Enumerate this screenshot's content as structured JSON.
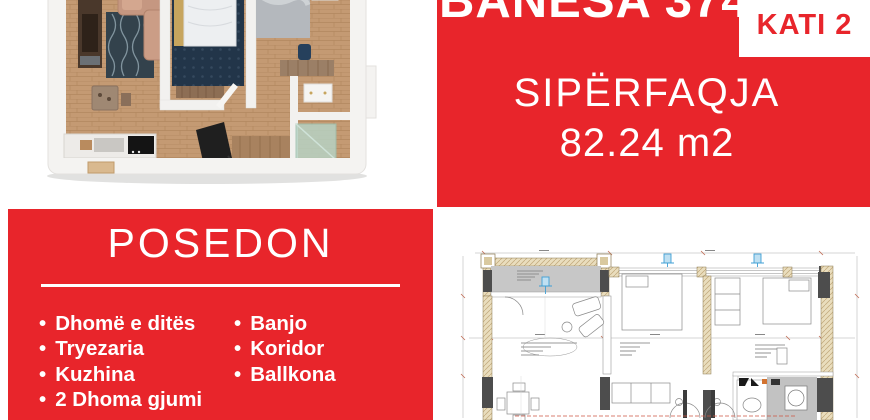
{
  "palette": {
    "red": "#e8252b",
    "badge_text": "#e8252b"
  },
  "banner": {
    "title": "BANESA 374",
    "floor_badge": "KATI 2",
    "area_label": "SIPËRFAQJA",
    "area_value": "82.24 m2"
  },
  "features": {
    "title": "POSEDON",
    "bullet": "•",
    "column1": [
      "Dhomë e ditës",
      "Tryezaria",
      "Kuzhina",
      "2 Dhoma gjumi"
    ],
    "column2": [
      "Banjo",
      "Koridor",
      "Ballkona"
    ]
  },
  "images": {
    "render_3d": "3d-apartment-floorplan-render",
    "plan_2d": "2d-architectural-floorplan-drawing"
  }
}
